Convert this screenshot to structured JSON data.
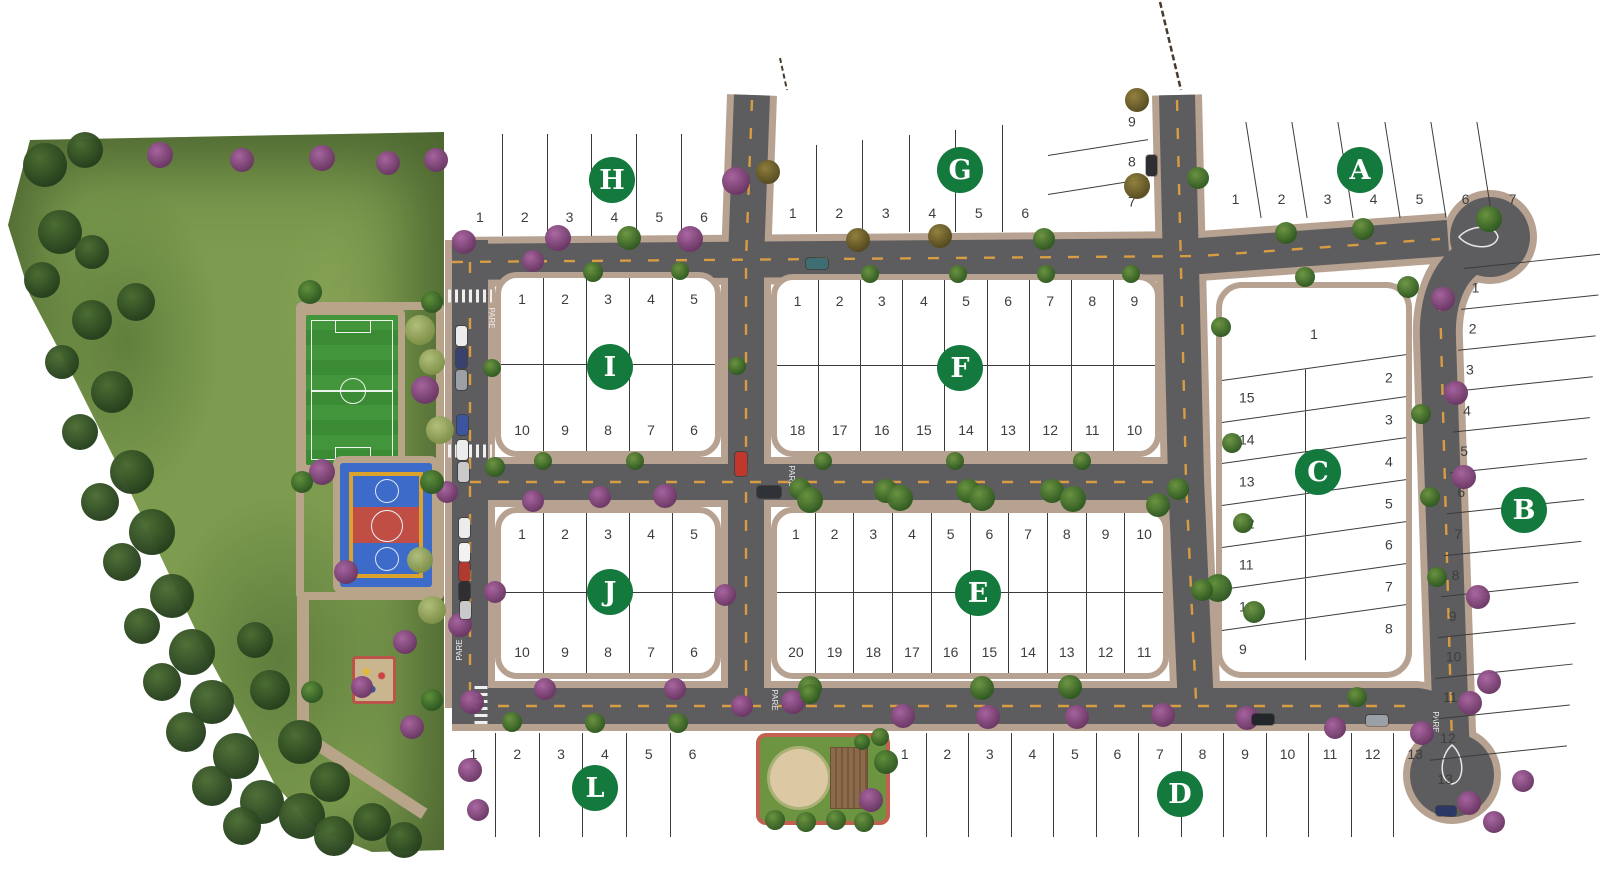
{
  "map": {
    "road_marking_label": "PARE",
    "theme": {
      "badge_color": "#14793c",
      "road_color": "#5d5c5e",
      "sidewalk_color": "#b7a190",
      "centerline_color": "#d89c42",
      "park_color": "#7d9c4f",
      "lot_line_color": "#3b3b3b"
    },
    "blocks": [
      {
        "id": "H",
        "layout": "row",
        "numbers_at": "bottom",
        "lots": [
          "1",
          "2",
          "3",
          "4",
          "5",
          "6"
        ]
      },
      {
        "id": "G",
        "layout": "row",
        "numbers_at": "bottom",
        "lots": [
          "1",
          "2",
          "3",
          "4",
          "5",
          "6"
        ],
        "side_lots": [
          "9",
          "8",
          "7"
        ]
      },
      {
        "id": "A",
        "layout": "row",
        "numbers_at": "bottom",
        "lots": [
          "1",
          "2",
          "3",
          "4",
          "5",
          "6",
          "7"
        ]
      },
      {
        "id": "I",
        "layout": "grid",
        "rows": [
          [
            "1",
            "2",
            "3",
            "4",
            "5"
          ],
          [
            "10",
            "9",
            "8",
            "7",
            "6"
          ]
        ]
      },
      {
        "id": "F",
        "layout": "grid",
        "rows": [
          [
            "1",
            "2",
            "3",
            "4",
            "5",
            "6",
            "7",
            "8",
            "9"
          ],
          [
            "18",
            "17",
            "16",
            "15",
            "14",
            "13",
            "12",
            "11",
            "10"
          ]
        ]
      },
      {
        "id": "C",
        "layout": "c-special",
        "lot_top": "1",
        "left_column": [
          "15",
          "14",
          "13",
          "12",
          "11",
          "10",
          "9"
        ],
        "right_column": [
          "2",
          "3",
          "4",
          "5",
          "6",
          "7",
          "8"
        ]
      },
      {
        "id": "B",
        "layout": "stack",
        "lots": [
          "1",
          "2",
          "3",
          "4",
          "5",
          "6",
          "7",
          "8",
          "9",
          "10",
          "11",
          "12",
          "13"
        ]
      },
      {
        "id": "J",
        "layout": "grid",
        "rows": [
          [
            "1",
            "2",
            "3",
            "4",
            "5"
          ],
          [
            "10",
            "9",
            "8",
            "7",
            "6"
          ]
        ]
      },
      {
        "id": "E",
        "layout": "grid",
        "rows": [
          [
            "1",
            "2",
            "3",
            "4",
            "5",
            "6",
            "7",
            "8",
            "9",
            "10"
          ],
          [
            "20",
            "19",
            "18",
            "17",
            "16",
            "15",
            "14",
            "13",
            "12",
            "11"
          ]
        ]
      },
      {
        "id": "L",
        "layout": "row",
        "numbers_at": "top",
        "lots": [
          "1",
          "2",
          "3",
          "4",
          "5",
          "6"
        ]
      },
      {
        "id": "D",
        "layout": "row",
        "numbers_at": "top",
        "lots": [
          "1",
          "2",
          "3",
          "4",
          "5",
          "6",
          "7",
          "8",
          "9",
          "10",
          "11",
          "12",
          "13"
        ]
      }
    ],
    "amenities": {
      "park": "park-green-area",
      "soccer_field": "soccer-field",
      "sports_court": "multi-sport-court",
      "playground": "playground",
      "pocket_park": "pocket-park-plaza"
    }
  }
}
